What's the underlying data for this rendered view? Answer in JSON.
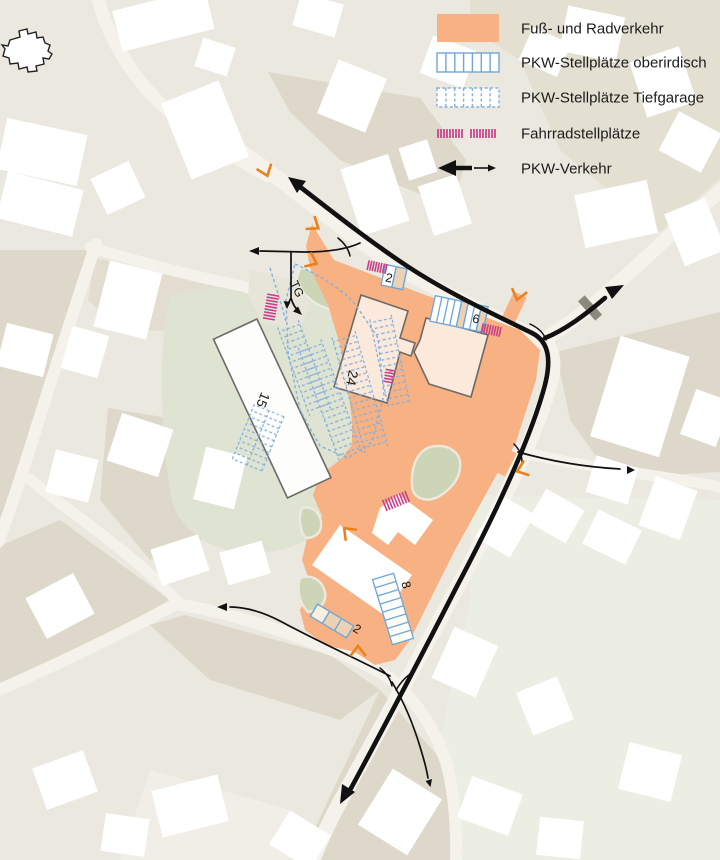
{
  "title": "Site mobility plan",
  "legend": {
    "items": [
      {
        "id": "pedestrian",
        "label": "Fuß- und Radverkehr",
        "swatch": "orange-fill-swatch"
      },
      {
        "id": "parking-surface",
        "label": "PKW-Stellplätze oberirdisch",
        "swatch": "blue-solid-hatch-swatch"
      },
      {
        "id": "parking-underground",
        "label": "PKW-Stellplätze Tiefgarage",
        "swatch": "blue-dashed-hatch-swatch"
      },
      {
        "id": "bike-parking",
        "label": "Fahrradstellplätze",
        "swatch": "pink-ticks-swatch"
      },
      {
        "id": "car-traffic",
        "label": "PKW-Verkehr",
        "swatch": "double-arrow-swatch"
      }
    ]
  },
  "map": {
    "parking_labels": {
      "surface_top": "2",
      "surface_east": "6",
      "underground_central": "24",
      "underground_west": "15",
      "surface_south": "8",
      "surface_southwest": "2"
    },
    "garage_entrance_label": "TG"
  },
  "colors": {
    "background": "#eae8df",
    "parcel_dark": "#ddd8c9",
    "road": "#f4f2eb",
    "building": "#ffffff",
    "pedestrian_area": "#f7b183",
    "plan_building_fill": "#fbe9db",
    "plan_building_stroke": "#6d6a66",
    "surface_parking_outline": "#6fa6d8",
    "underground_parking_outline": "#85b0de",
    "stall_beige": "#ecd2b5",
    "bike_parking": "#c9408a",
    "green_space": "#ccd6b7",
    "green_space_pale": "#dfe3d1",
    "traffic": "#111111",
    "entrance_marker": "#e8821e"
  }
}
